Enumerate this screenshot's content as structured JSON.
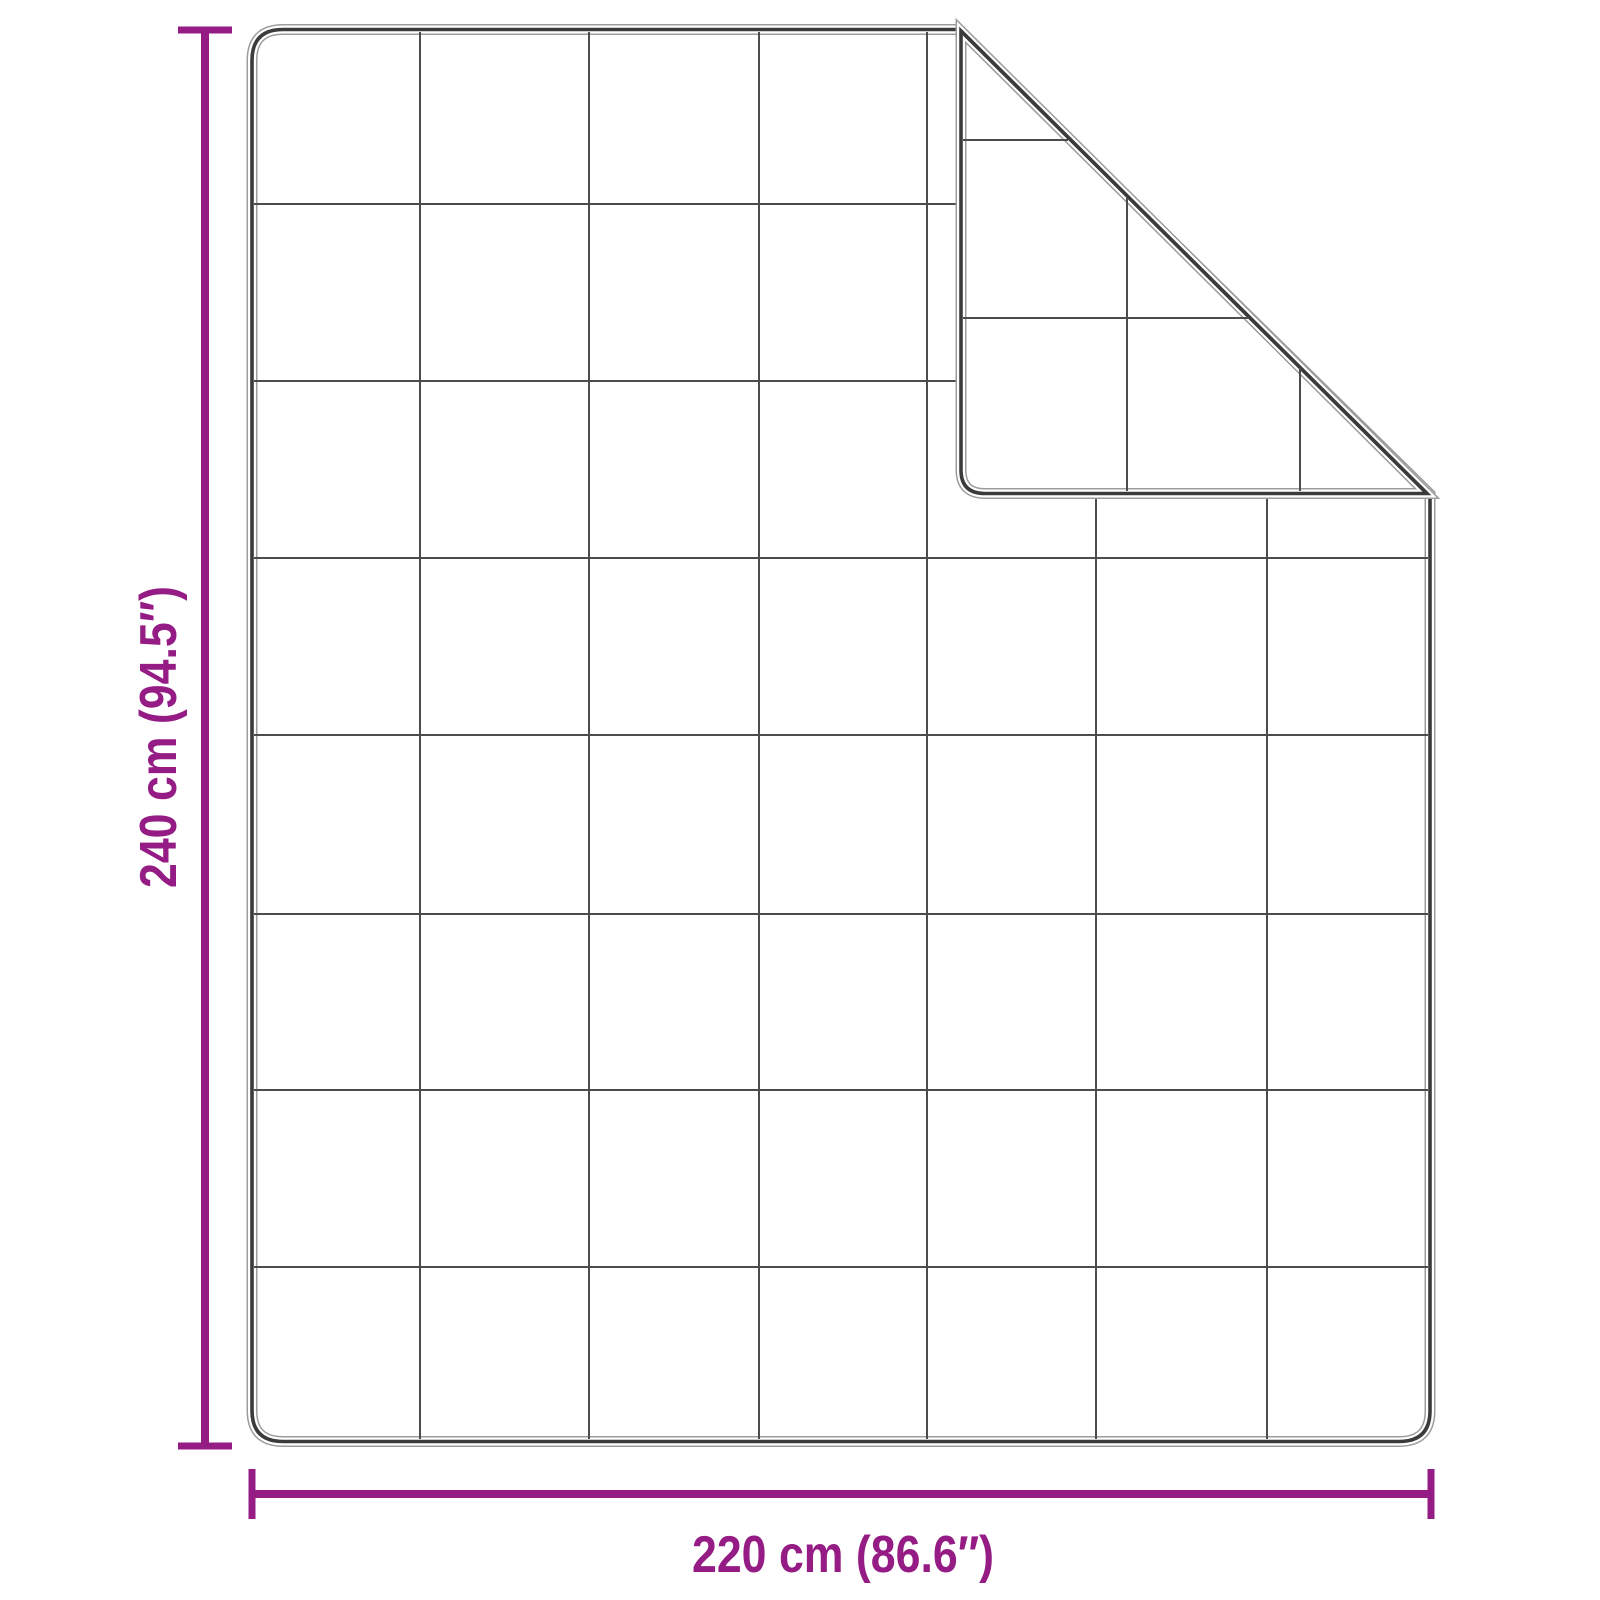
{
  "diagram": {
    "type": "product-dimension-diagram",
    "subject": "quilted blanket with folded top-right corner",
    "height_label": "240 cm (94.5″)",
    "width_label": "220 cm (86.6″)",
    "height_cm": 240,
    "height_inches": 94.5,
    "width_cm": 220,
    "width_inches": 86.6,
    "accent_color": "#941c84",
    "outline_color": "#3b3b3b",
    "grid_columns": 7,
    "grid_rows": 8
  }
}
